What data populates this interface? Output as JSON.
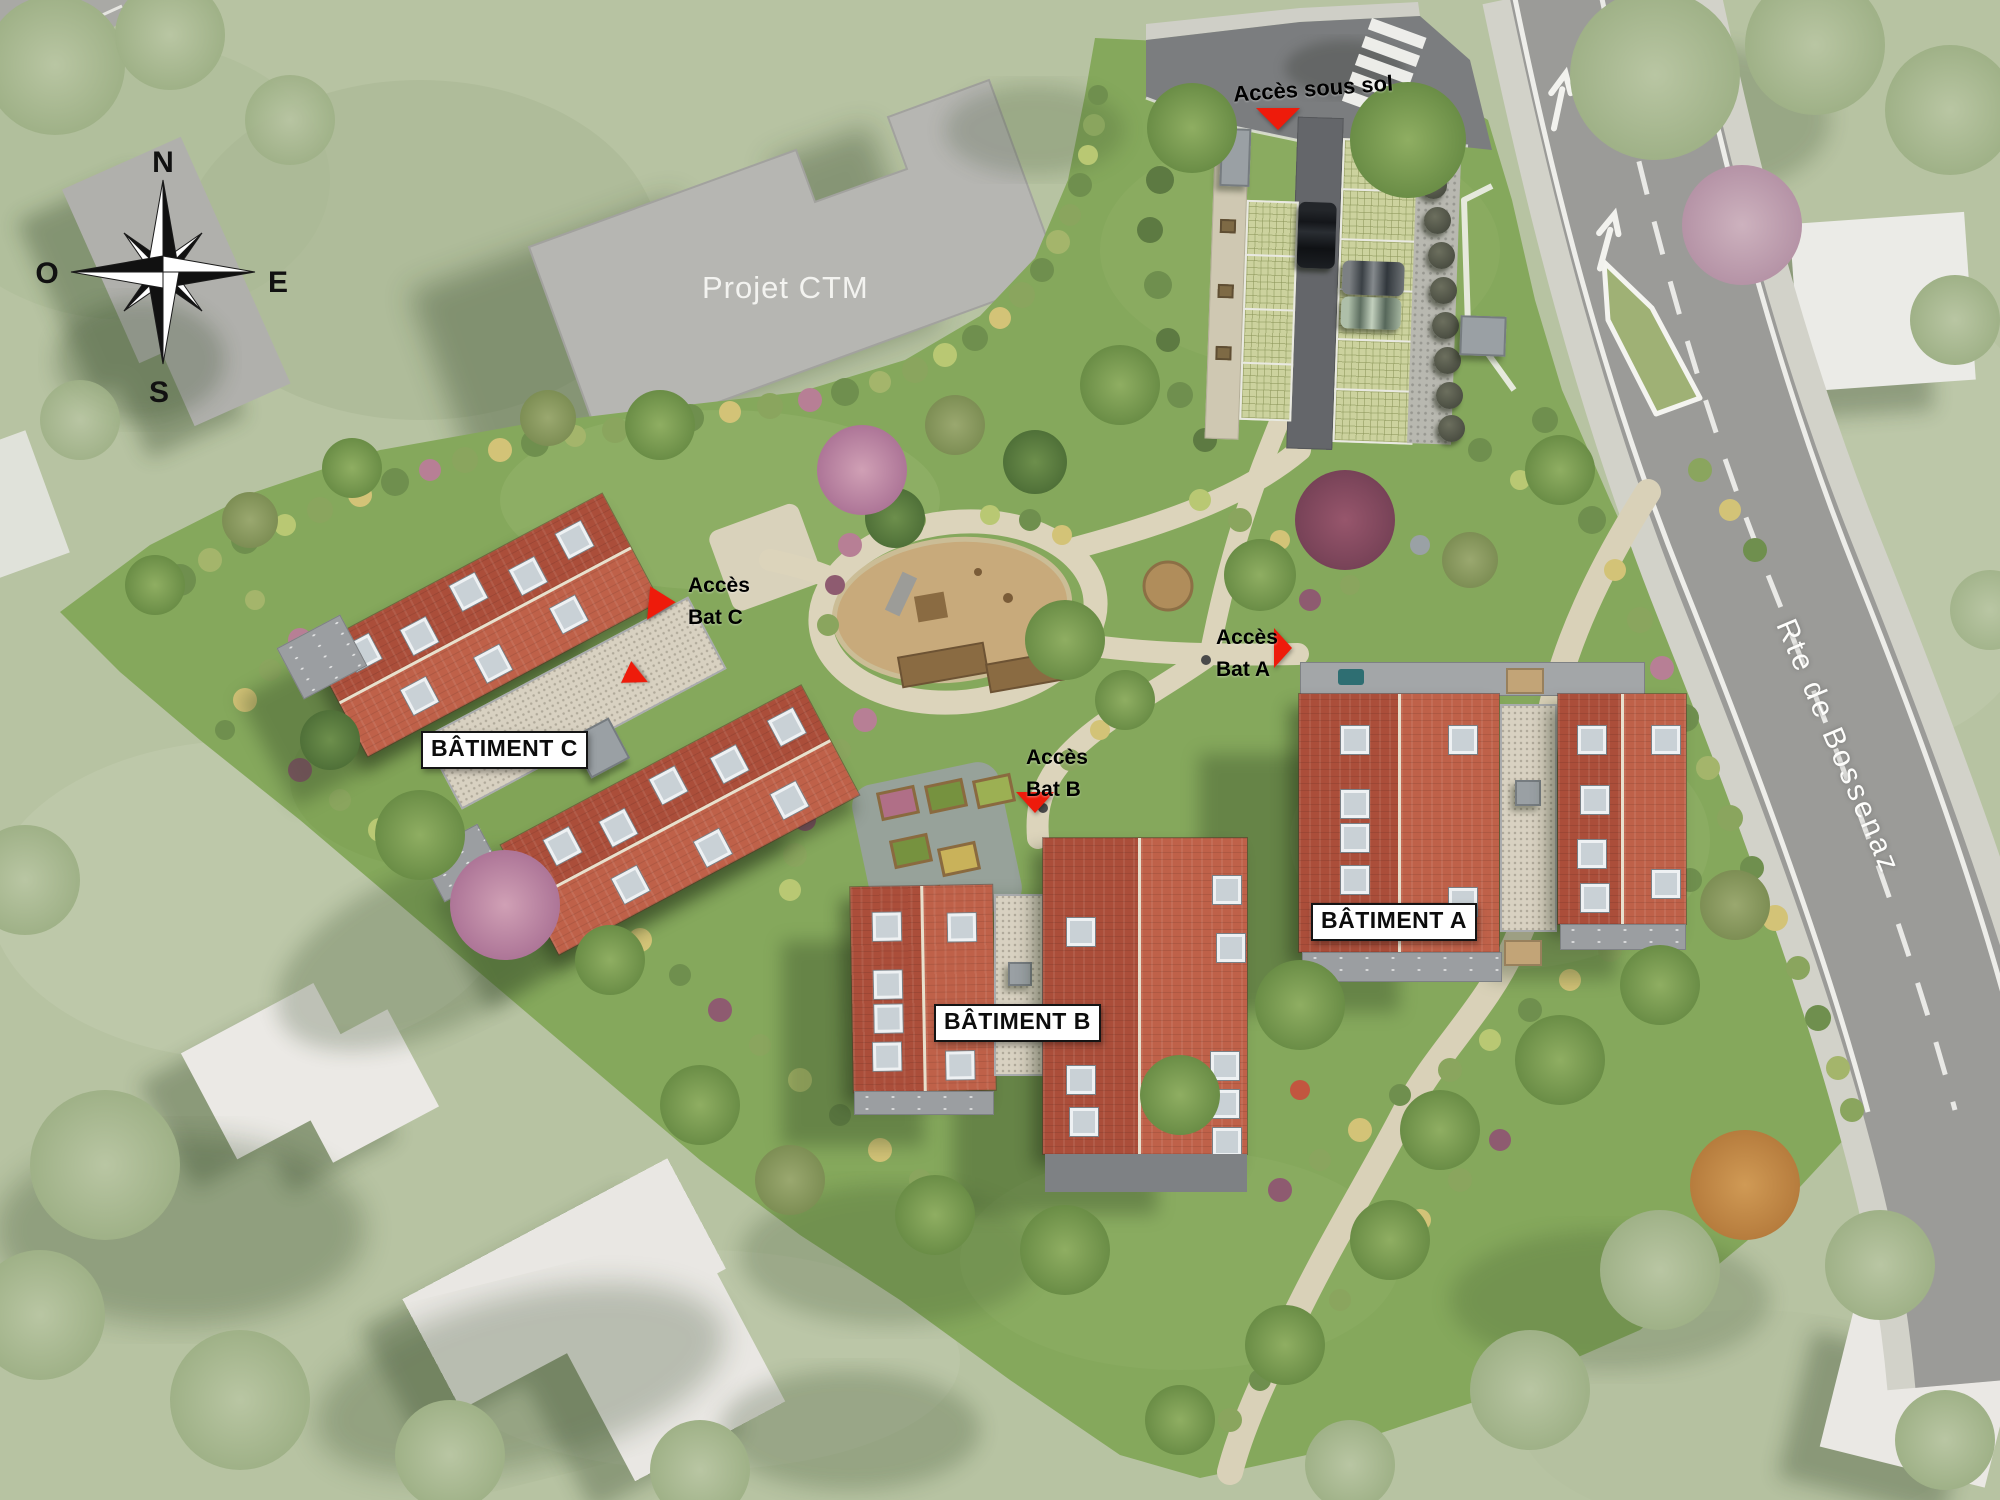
{
  "compass": {
    "n": "N",
    "o": "O",
    "e": "E",
    "s": "S"
  },
  "neighbor": {
    "projet_ctm": "Projet CTM"
  },
  "road": {
    "name": "Rte de Bossenaz"
  },
  "access": {
    "sous_sol": "Accès sous sol",
    "bat_c_line1": "Accès",
    "bat_c_line2": "Bat C",
    "bat_b_line1": "Accès",
    "bat_b_line2": "Bat B",
    "bat_a_line1": "Accès",
    "bat_a_line2": "Bat A"
  },
  "buildings": {
    "a": "BÂTIMENT A",
    "b": "BÂTIMENT B",
    "c": "BÂTIMENT C"
  },
  "colors": {
    "accent_red": "#ee1b0b",
    "roof_dark": "#ab4e3a",
    "roof_light": "#bf6149",
    "site_green": "#85a85c",
    "road_gray": "#9a9a97",
    "path_beige": "#ddd5bd",
    "label_bg": "#ffffff",
    "label_border": "#141414"
  }
}
